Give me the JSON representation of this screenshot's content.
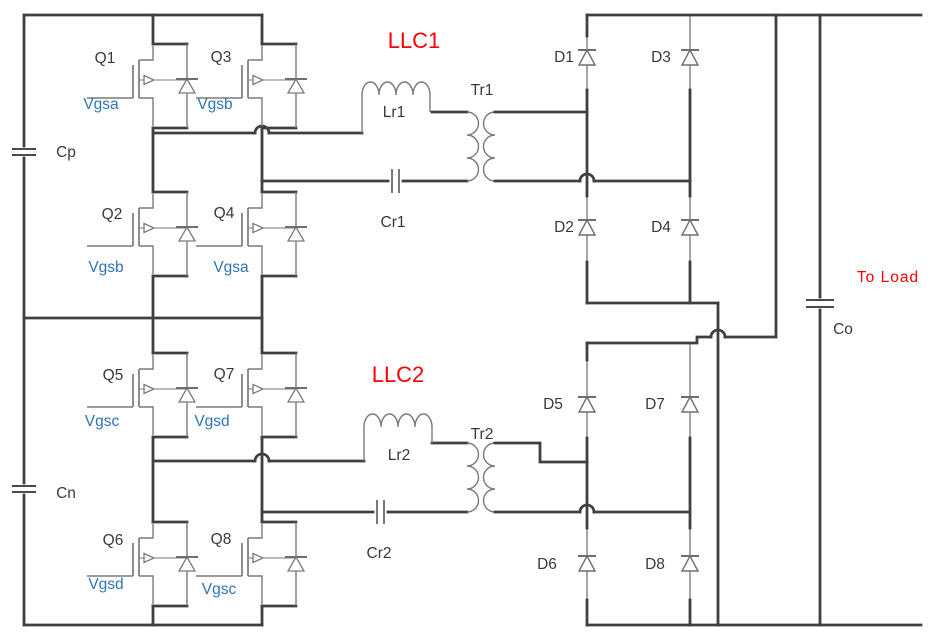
{
  "palette": {
    "wire": "#404040",
    "symbol_gray": "#7a7a7a",
    "label_text": "#3a3a3a",
    "gate_label_blue": "#2e75b6",
    "section_label_red": "#fb0006",
    "background": "#ffffff"
  },
  "input_stage": {
    "split_capacitors": [
      {
        "label": "Cp"
      },
      {
        "label": "Cn"
      }
    ],
    "bridges": [
      {
        "switches": [
          {
            "label": "Q1",
            "gate": "Vgsa"
          },
          {
            "label": "Q2",
            "gate": "Vgsb"
          },
          {
            "label": "Q3",
            "gate": "Vgsb"
          },
          {
            "label": "Q4",
            "gate": "Vgsa"
          }
        ]
      },
      {
        "switches": [
          {
            "label": "Q5",
            "gate": "Vgsc"
          },
          {
            "label": "Q6",
            "gate": "Vgsd"
          },
          {
            "label": "Q7",
            "gate": "Vgsd"
          },
          {
            "label": "Q8",
            "gate": "Vgsc"
          }
        ]
      }
    ]
  },
  "resonant_tanks": [
    {
      "title": "LLC1",
      "inductor": "Lr1",
      "capacitor": "Cr1",
      "transformer": "Tr1"
    },
    {
      "title": "LLC2",
      "inductor": "Lr2",
      "capacitor": "Cr2",
      "transformer": "Tr2"
    }
  ],
  "rectifiers": [
    {
      "diodes": [
        "D1",
        "D2",
        "D3",
        "D4"
      ]
    },
    {
      "diodes": [
        "D5",
        "D6",
        "D7",
        "D8"
      ]
    }
  ],
  "output_stage": {
    "capacitor": "Co",
    "load": "To Load"
  }
}
